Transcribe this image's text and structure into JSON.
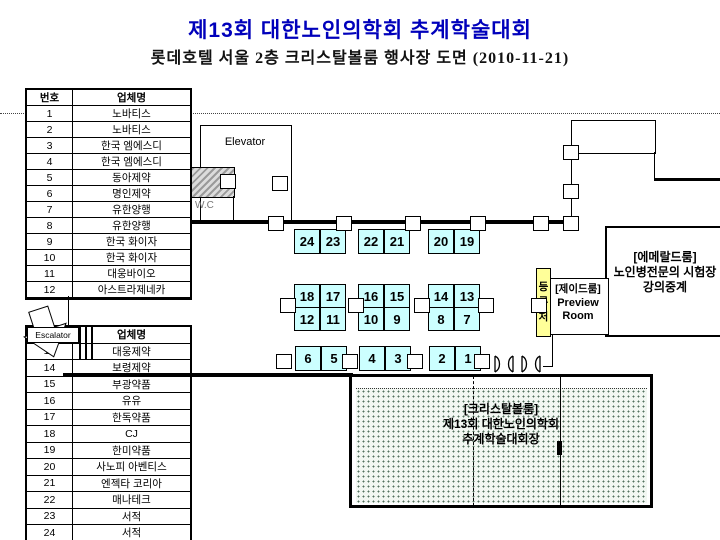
{
  "header": {
    "title": "제13회 대한노인의학회 추계학술대회",
    "subtitle": "롯데호텔 서울 2층 크리스탈볼룸 행사장 도면 (2010-11-21)",
    "title_color": "#0000bb"
  },
  "exhibitor_table": {
    "headers": {
      "no": "번호",
      "name": "업체명"
    },
    "section1": [
      {
        "no": "1",
        "name": "노바티스"
      },
      {
        "no": "2",
        "name": "노바티스"
      },
      {
        "no": "3",
        "name": "한국 엠에스디"
      },
      {
        "no": "4",
        "name": "한국 엠에스디"
      },
      {
        "no": "5",
        "name": "동아제약"
      },
      {
        "no": "6",
        "name": "명인제약"
      },
      {
        "no": "7",
        "name": "유한양행"
      },
      {
        "no": "8",
        "name": "유한양행"
      },
      {
        "no": "9",
        "name": "한국 화이자"
      },
      {
        "no": "10",
        "name": "한국 화이자"
      },
      {
        "no": "11",
        "name": "대웅바이오"
      },
      {
        "no": "12",
        "name": "아스트라제네카"
      }
    ],
    "section2": [
      {
        "no": "13",
        "name": "대웅제약"
      },
      {
        "no": "14",
        "name": "보령제약"
      },
      {
        "no": "15",
        "name": "부광약품"
      },
      {
        "no": "16",
        "name": "유유"
      },
      {
        "no": "17",
        "name": "한독약품"
      },
      {
        "no": "18",
        "name": "CJ"
      },
      {
        "no": "19",
        "name": "한미약품"
      },
      {
        "no": "20",
        "name": "사노피 아벤티스"
      },
      {
        "no": "21",
        "name": "엔젝타 코리아"
      },
      {
        "no": "22",
        "name": "매나테크"
      },
      {
        "no": "23",
        "name": "서적"
      },
      {
        "no": "24",
        "name": "서적"
      }
    ]
  },
  "floor_plan": {
    "labels": {
      "elevator": "Elevator",
      "wc": "W.C",
      "escalator": "Escalator",
      "registration": "등록처"
    },
    "rooms": {
      "jade": {
        "name": "[제이드룸]",
        "line2": "Preview",
        "line3": "Room"
      },
      "emerald": {
        "name": "[에메랄드룸]",
        "line2": "노인병전문의 시험장",
        "line3": "강의중계"
      },
      "crystal": {
        "name": "[크리스탈볼룸]",
        "line2": "제13회 대한노인의학회",
        "line3": "추계학술대회장"
      }
    },
    "booth_rows": {
      "top": [
        "24",
        "23",
        "22",
        "21",
        "20",
        "19"
      ],
      "middle_upper": [
        "18",
        "17",
        "16",
        "15",
        "14",
        "13"
      ],
      "middle_lower": [
        "12",
        "11",
        "10",
        "9",
        "8",
        "7"
      ],
      "bottom": [
        "6",
        "5",
        "4",
        "3",
        "2",
        "1"
      ]
    },
    "colors": {
      "booth_fill": "#ccffff",
      "registration_fill": "#ffff99",
      "title_blue": "#0000bb"
    }
  }
}
